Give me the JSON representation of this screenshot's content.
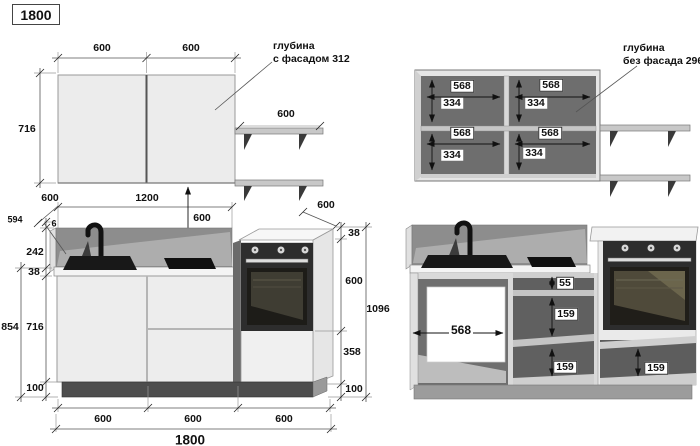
{
  "title": "1800",
  "colors": {
    "background": "#ffffff",
    "dimension_line": "#444444",
    "cabinet_front": "#ececec",
    "cabinet_interior": "#6e6e6e",
    "backsplash": "#8d8d8d",
    "appliance_dark": "#2d2d2d",
    "plinth_dark": "#4d4d4d"
  },
  "views": {
    "wall_closed": {
      "dims": {
        "width_left": "600",
        "width_right": "600",
        "height": "716",
        "shelf_width": "600"
      },
      "depth_note": {
        "line1": "глубина",
        "line2": "с фасадом 312"
      }
    },
    "wall_open": {
      "dims": {
        "top_left_width": "568",
        "top_left_height": "334",
        "top_right_width": "568",
        "top_right_height": "334",
        "bottom_left_width": "568",
        "bottom_left_height": "334",
        "bottom_right_width": "568",
        "bottom_right_height": "334"
      },
      "depth_note": {
        "line1": "глубина",
        "line2": "без фасада 296"
      }
    },
    "base_closed": {
      "dims": {
        "oblique_left_depth": "600",
        "sink_run_width": "1200",
        "wall_to_counter_gap": "600",
        "oblique_right_depth": "600",
        "panel_height": "594",
        "panel_thickness": "6",
        "backsplash_height": "242",
        "countertop_thickness": "38",
        "body_plus_plinth": "854",
        "body_height": "716",
        "plinth_height": "100",
        "tower_top_thickness": "38",
        "tower_oven_height": "600",
        "tower_total_height": "1096",
        "tower_drawer_height": "358",
        "tower_plinth_height": "100",
        "section1_width": "600",
        "section2_width": "600",
        "section3_width": "600",
        "total_width": "1800"
      }
    },
    "base_open": {
      "dims": {
        "sink_cabinet_inner_width": "568",
        "top_drawer_inner": "55",
        "middle_drawer_inner": "159",
        "bottom_drawer_inner": "159",
        "tower_drawer_inner": "159"
      }
    }
  }
}
